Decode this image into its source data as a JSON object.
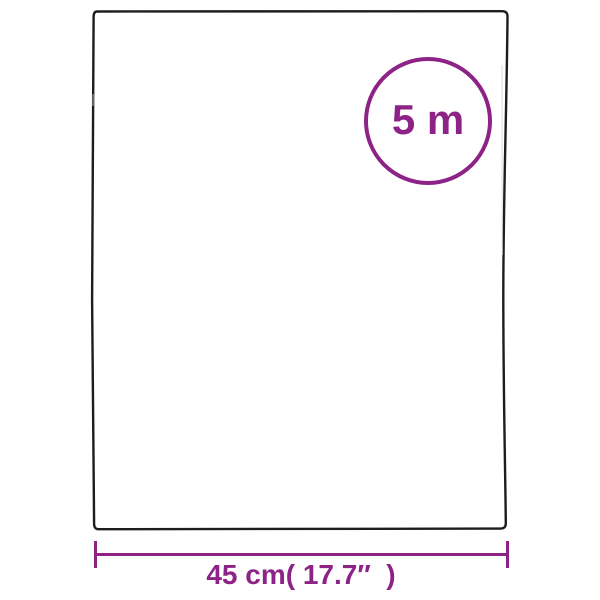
{
  "diagram": {
    "roll_length_badge": {
      "label": "5 m"
    },
    "width_dimension": {
      "label": "45 cm( 17.7″  )"
    },
    "colors": {
      "accent_purple": "#8E2387",
      "sheet_outline": "#1D1D1D",
      "background": "#FFFFFF"
    }
  }
}
